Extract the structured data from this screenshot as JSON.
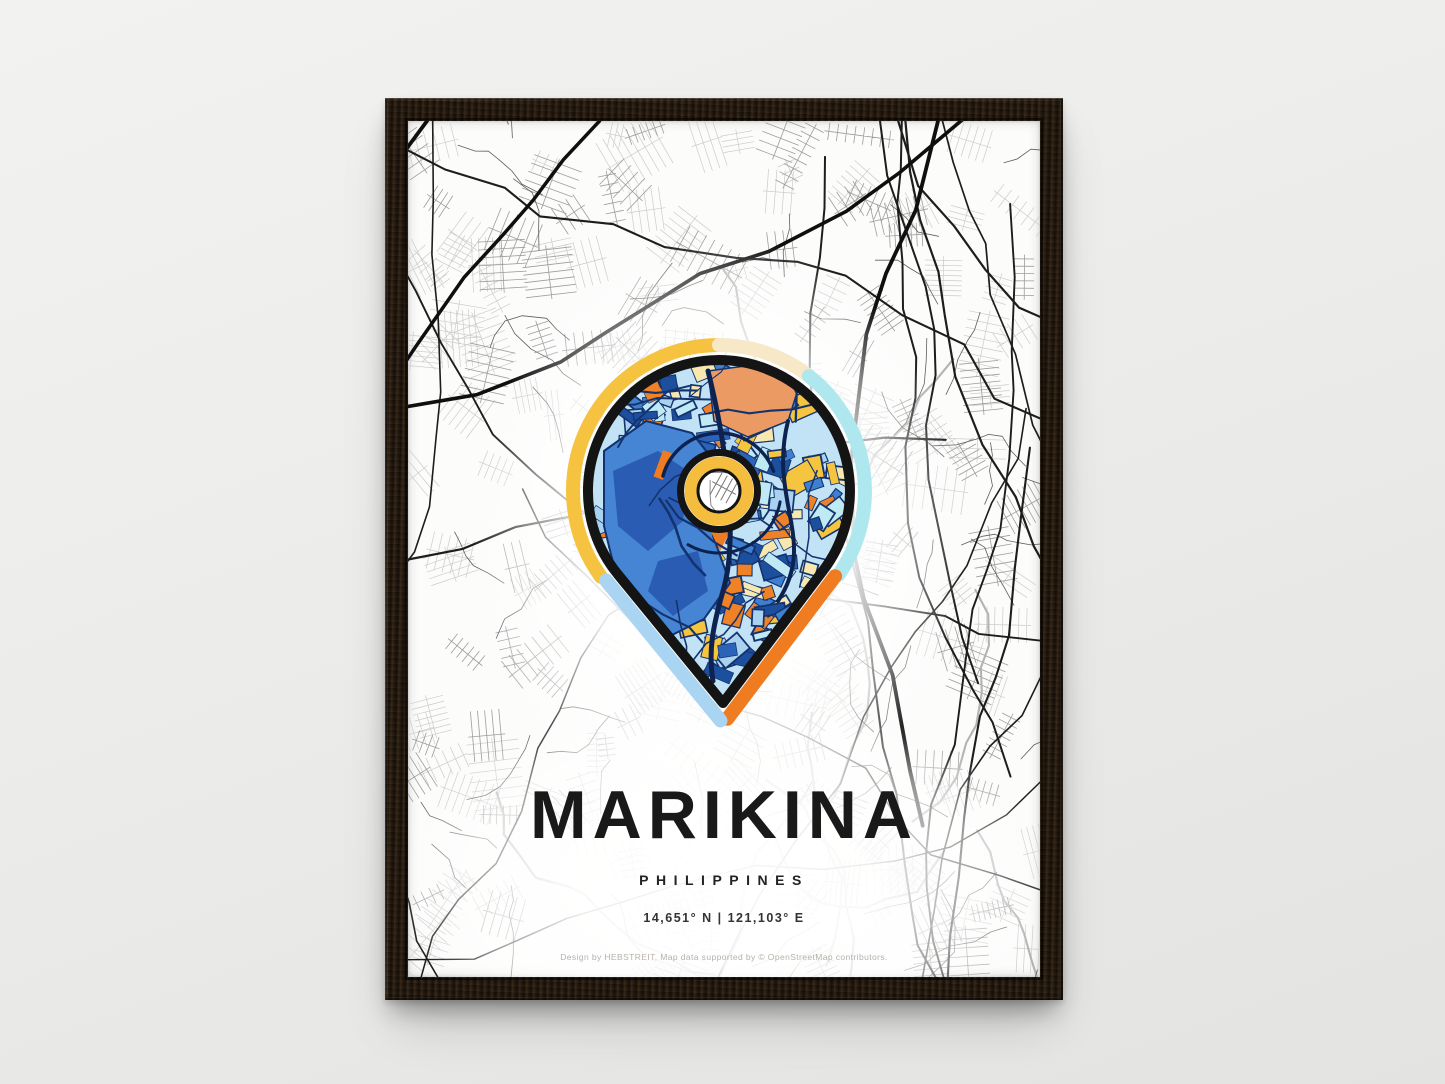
{
  "poster": {
    "title": "MARIKINA",
    "subtitle": "PHILIPPINES",
    "coordinates": "14,651° N | 121,103° E",
    "credit": "Design by HEBSTREIT, Map data supported by © OpenStreetMap contributors.",
    "pin_palette": [
      "#ef8226",
      "#f6c53f",
      "#f8e8b0",
      "#bfe9f3",
      "#3f7fd0",
      "#1c4f9e",
      "#a9d2f0",
      "#2a63b8"
    ],
    "colors": {
      "wall": "#ebebe9",
      "frame_wood": "#241a10",
      "paper": "#fcfcfb",
      "map_light": "#cccccc",
      "map_mid": "#9d9d9d",
      "map_minor_dark": "#5f5f5f",
      "map_gray_road": "#b3b3b3",
      "map_road": "#1d1d1d",
      "map_road_thick": "#0f0f0f",
      "pin_outline": "#141414",
      "pin_base": "#c2e3f5",
      "pin_river": "#b5d9f3",
      "pin_water": "#4585d4",
      "pin_water_dark": "#2a5cb4",
      "pin_salmon": "#ec9a63",
      "pin_navy": "#14336e",
      "pin_road_dark": "#0e2250",
      "halo_yellow": "#f6c341",
      "halo_cream": "#f7e9c8",
      "halo_cyan": "#aee8ee",
      "halo_light_blue": "#a9d4f2",
      "halo_orange": "#f07c22",
      "ring_yellow": "#f5bd3e"
    }
  }
}
